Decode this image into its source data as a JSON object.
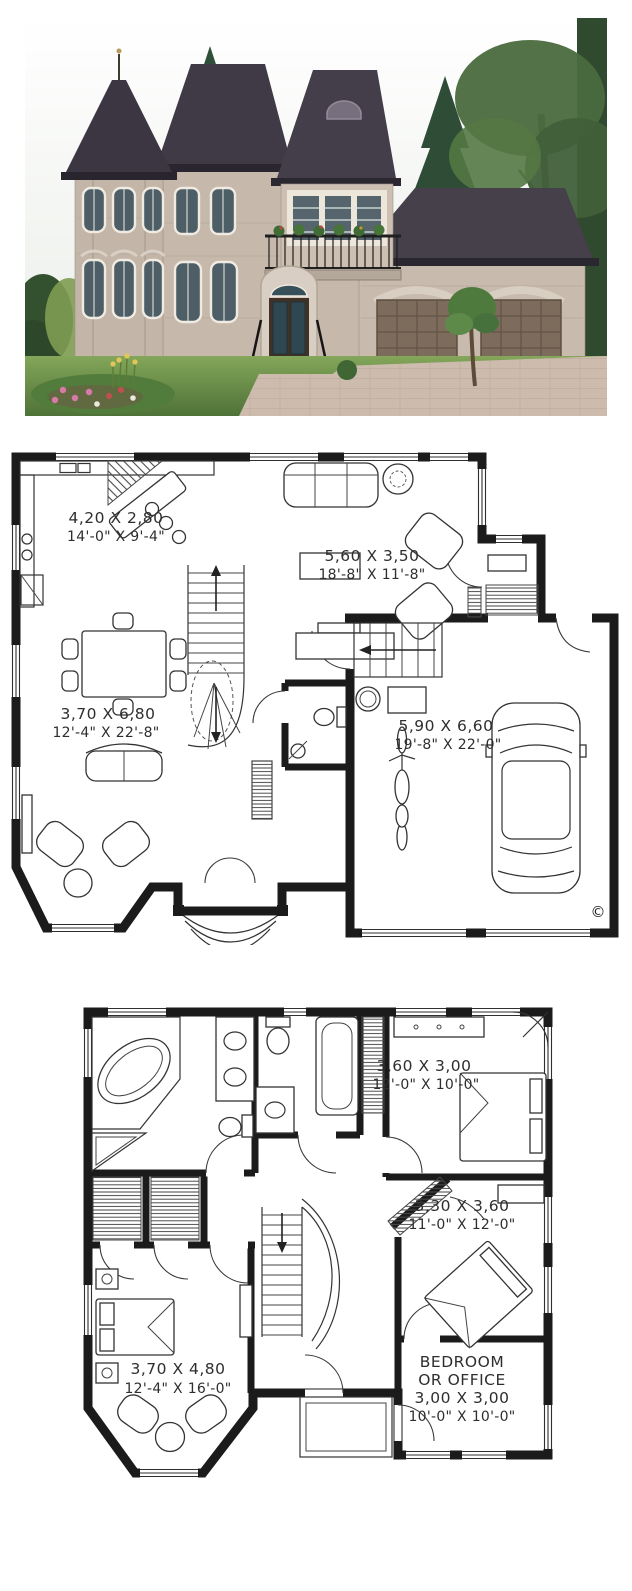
{
  "house_rendering": {
    "description_icon": "house-photo",
    "palette": {
      "sky": "#f2f5f1",
      "roof": "#413b46",
      "stone": "#c6b8ab",
      "stone_light": "#cdbfb2",
      "trim": "#efe9e0",
      "garage_door": "#7d6c5b",
      "foliage_dark": "#31503a",
      "foliage_mid": "#4a6a3e",
      "lawn": "#6f9a4a",
      "driveway": "#cdbcae",
      "flowers_pink": "#d77ba6",
      "flowers_yellow": "#e2c657"
    }
  },
  "first_floor_plan": {
    "rooms": [
      {
        "id": "kitchen",
        "metric": "4,20 X 2,80",
        "imperial": "14'-0\" X 9'-4\""
      },
      {
        "id": "living-room",
        "metric": "5,60 X 3,50",
        "imperial": "18'-8\" X 11'-8\""
      },
      {
        "id": "dining-room",
        "metric": "3,70 X 6,80",
        "imperial": "12'-4\" X 22'-8\""
      },
      {
        "id": "garage",
        "metric": "5,90 X 6,60",
        "imperial": "19'-8\" X 22'-0\""
      }
    ],
    "copyright_mark": "©"
  },
  "second_floor_plan": {
    "rooms": [
      {
        "id": "bedroom-2",
        "metric": "3,60 X 3,00",
        "imperial": "12'-0\" X 10'-0\""
      },
      {
        "id": "bedroom-3",
        "metric": "3,30 X 3,60",
        "imperial": "11'-0\" X 12'-0\""
      },
      {
        "id": "bedroom-or-office",
        "title_line1": "BEDROOM",
        "title_line2": "OR OFFICE",
        "metric": "3,00 X 3,00",
        "imperial": "10'-0\" X 10'-0\""
      },
      {
        "id": "master-bedroom",
        "metric": "3,70 X 4,80",
        "imperial": "12'-4\" X 16'-0\""
      }
    ]
  }
}
